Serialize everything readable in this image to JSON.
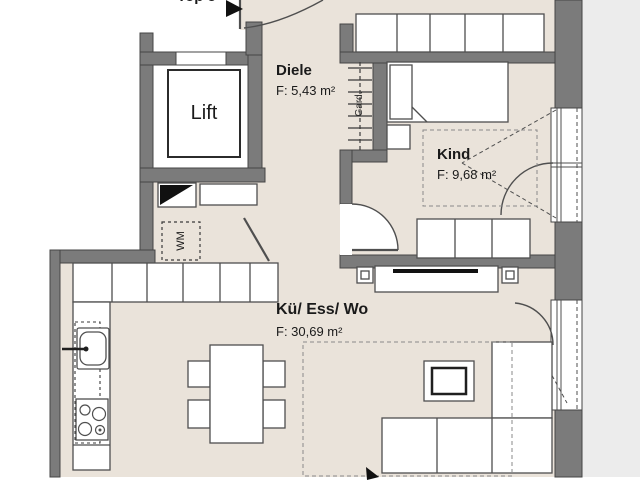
{
  "plan": {
    "unit": {
      "label": "Top 5"
    },
    "rooms": {
      "diele": {
        "name": "Diele",
        "area": "F: 5,43 m²"
      },
      "kind": {
        "name": "Kind",
        "area": "F: 9,68 m²"
      },
      "living": {
        "name": "Kü/ Ess/ Wo",
        "area": "F: 30,69 m²"
      }
    },
    "features": {
      "lift": "Lift",
      "wardrobe": "Gard.",
      "washing_machine": "WM"
    },
    "colors": {
      "wall": "#7b7b7b",
      "wall_edge": "#454545",
      "floor_beige": "#eae3da",
      "outside_gray": "#ececec",
      "furniture_line": "#4f4f4f",
      "text": "#1a1a1a",
      "tv_black": "#111111"
    }
  }
}
